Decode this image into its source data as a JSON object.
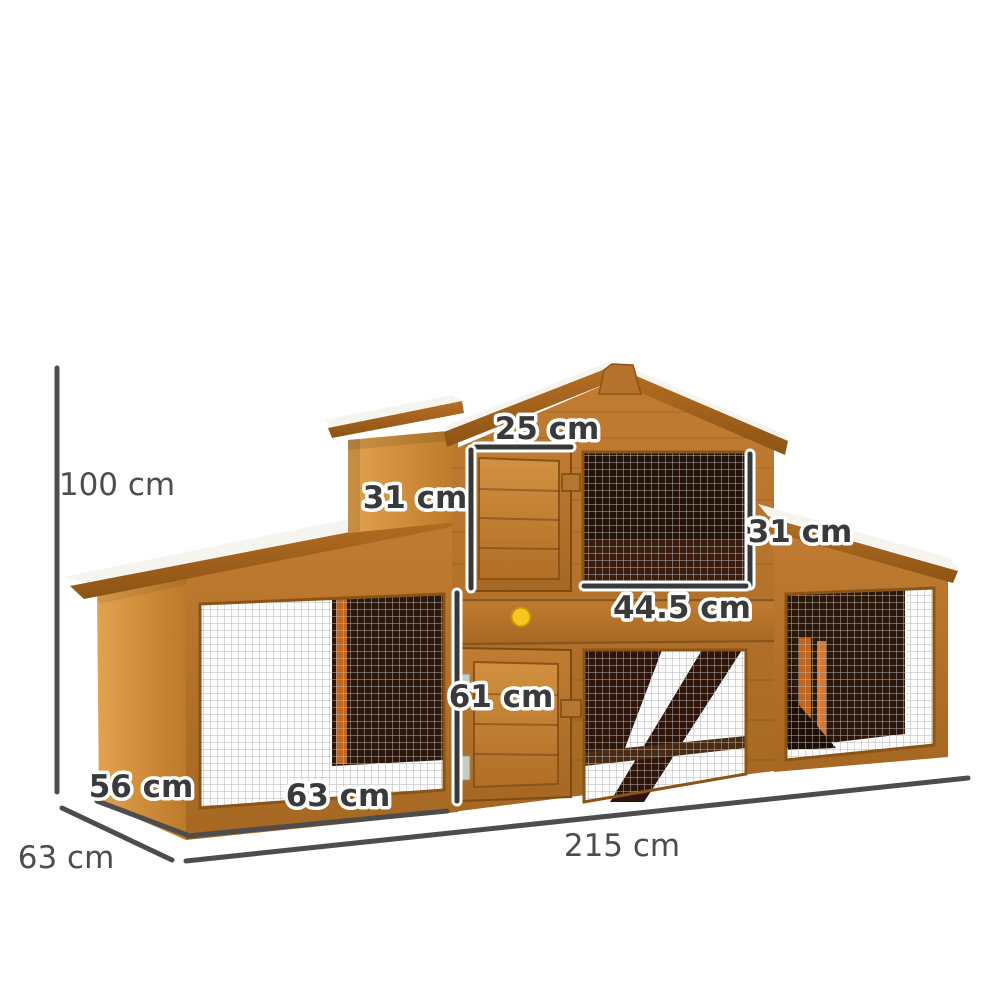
{
  "product": {
    "type": "wooden rabbit hutch / chicken coop dimension diagram",
    "unit": "cm"
  },
  "dimensions": {
    "overall_height": "100 cm",
    "upper_door_width": "25 cm",
    "upper_door_height": "31 cm",
    "right_section_height": "31 cm",
    "upper_run_width": "44.5 cm",
    "lower_front_height": "61 cm",
    "hutch_depth": "56 cm",
    "left_run_width": "63 cm",
    "base_depth": "63 cm",
    "overall_length": "215 cm"
  },
  "colors": {
    "background": "#ffffff",
    "wood_front": "#b5722c",
    "wood_side": "#d9973f",
    "wood_fascia": "#a26020",
    "roof_top": "#f6f4ef",
    "mesh_grid": "#b4b4b4",
    "interior_dark": "#261307",
    "dimension_line": "#3f3f3f",
    "dimension_line_casing": "#ffffff",
    "knob_yellow": "#f6c61e"
  }
}
